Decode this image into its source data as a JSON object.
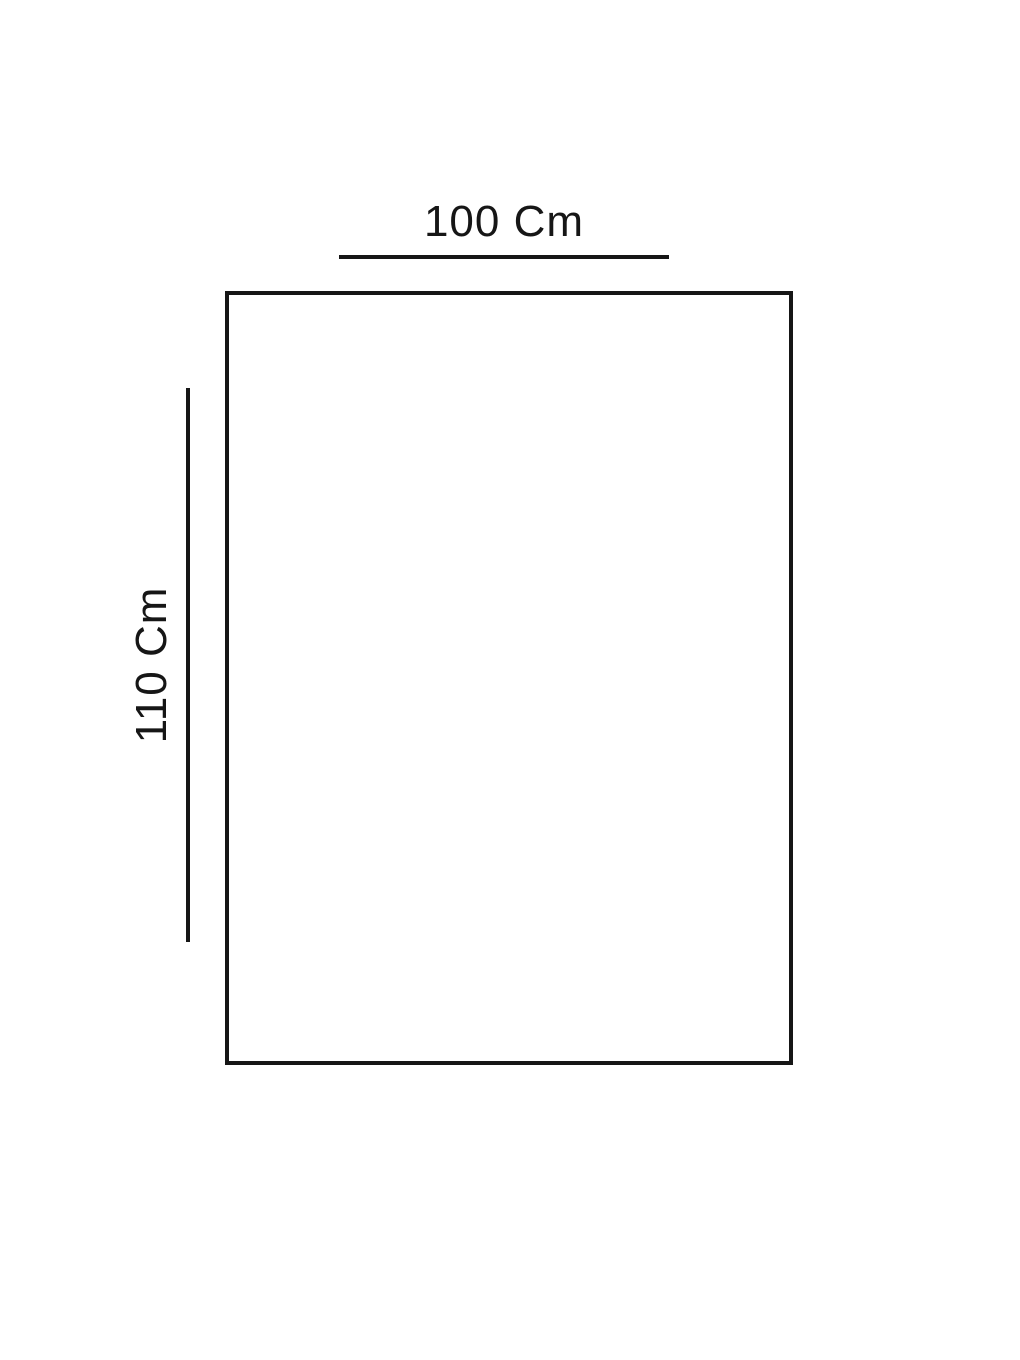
{
  "page": {
    "background": "#ffffff"
  },
  "diagram": {
    "shape": "rectangle",
    "line_color": "#161616",
    "outline_width_px": 4,
    "width_dimension": {
      "label": "100 Cm"
    },
    "height_dimension": {
      "label": "110 Cm"
    }
  }
}
